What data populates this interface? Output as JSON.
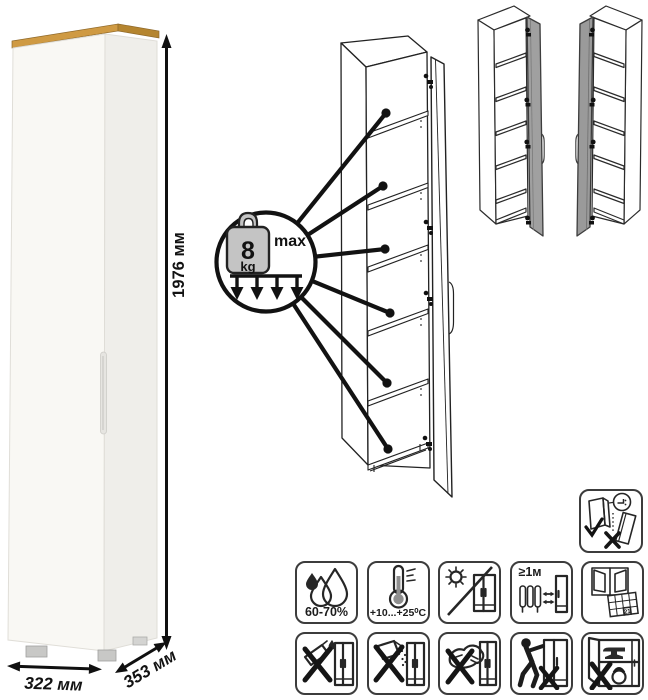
{
  "dimensions": {
    "height": "1976 мм",
    "width": "322 мм",
    "depth": "353 мм"
  },
  "load": {
    "value": "8",
    "unit": "kg",
    "max": "max"
  },
  "care": {
    "humidity": "60-70%",
    "temperature": "+10...+25⁰C",
    "distance": "≥1м",
    "calendar_day": "21"
  },
  "icons": {
    "standalone": "secure-to-wall-anti-tip-icon",
    "row1": [
      "humidity-icon",
      "temperature-range-icon",
      "no-direct-sunlight-icon",
      "keep-1m-from-heat-icon",
      "ventilation-calendar-icon"
    ],
    "row2": [
      "no-excess-water-icon",
      "no-abrasive-powder-icon",
      "no-scraping-icon",
      "no-dragging-icon",
      "no-overloading-icon"
    ]
  },
  "colors": {
    "wood_top": "#cf9a43",
    "wood_side": "#b5852f",
    "cabinet_front": "#f9f8f4",
    "cabinet_side": "#efeeea",
    "door_gray": "#a0a0a0",
    "weight_fill": "#c4c4c4",
    "line": "#121212"
  }
}
